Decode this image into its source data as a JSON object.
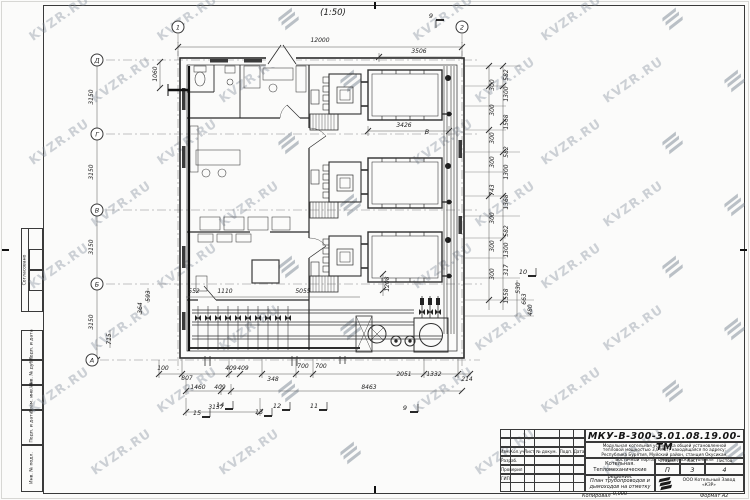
{
  "sheet": {
    "scale_note": "(1:50)",
    "copied_label": "Копировал",
    "format_label": "Формат А2"
  },
  "watermark": {
    "text": "KVZR.RU"
  },
  "side_stamp": {
    "approved_label": "Согласовано",
    "cells": [
      "Подп. и дата",
      "Инв. № дубл.",
      "Взам. инв. №",
      "Подп. и дата",
      "Инв. № подл."
    ]
  },
  "title_block": {
    "doc_number": "МКУ-В-300-3.01.08.19.00-ТМ",
    "description_lines": [
      "Модульная котельная установка общей установленной",
      "тепловой мощностью 3,0 МВт, находящаяся по адресу:",
      "Республика Бурятия, Муйский район, станция Окусикан,",
      "Восточный портал Северомуйского тоннеля"
    ],
    "object_line1": "Котельная.",
    "object_line2": "Тепломеханические решения.",
    "sheet_title_line1": "План трубопроводов и",
    "sheet_title_line2": "дымоходов на отметку 0,000",
    "stage_label": "Стадия",
    "list_label": "Лист",
    "lists_label": "Листов",
    "stage_value": "П",
    "list_value": "3",
    "lists_value": "4",
    "company_line1": "ООО Котельный",
    "company_line2": "Завод",
    "company_line3": "«КЗР»",
    "header_columns": [
      "Изм.",
      "Кол.уч",
      "Лист",
      "№ докум.",
      "Подп.",
      "Дата"
    ],
    "signature_rows": [
      "Разраб.",
      "Проверил",
      "ГИП"
    ]
  },
  "axes": {
    "top": [
      "1",
      "2"
    ],
    "left": [
      "Д",
      "Г",
      "В",
      "Б",
      "А"
    ]
  },
  "dims": {
    "top": [
      "12000",
      "3506"
    ],
    "inner": [
      "3426",
      "1060",
      "552",
      "1110",
      "5055",
      "1208"
    ],
    "left": [
      "3150",
      "3150",
      "3150",
      "3150",
      "593",
      "364",
      "715"
    ],
    "bottom1": [
      "100",
      "807",
      "409",
      "409",
      "348",
      "700",
      "700",
      "2051",
      "1332",
      "214"
    ],
    "bottom2": [
      "1460",
      "409",
      "8463"
    ],
    "bottom3": [
      "3137"
    ],
    "right_outer": [
      "582",
      "1300",
      "1568",
      "582",
      "1300",
      "1368",
      "582",
      "1300",
      "317",
      "1558"
    ],
    "right_inner": [
      "300",
      "300",
      "300",
      "300",
      "743",
      "300",
      "300",
      "300"
    ],
    "right_far": [
      "530",
      "663",
      "480"
    ]
  },
  "markers": {
    "top": [
      "9"
    ],
    "bottom": [
      "15",
      "14",
      "13",
      "12",
      "11",
      "9"
    ],
    "right": [
      "10"
    ],
    "equipment_tag": "В"
  }
}
